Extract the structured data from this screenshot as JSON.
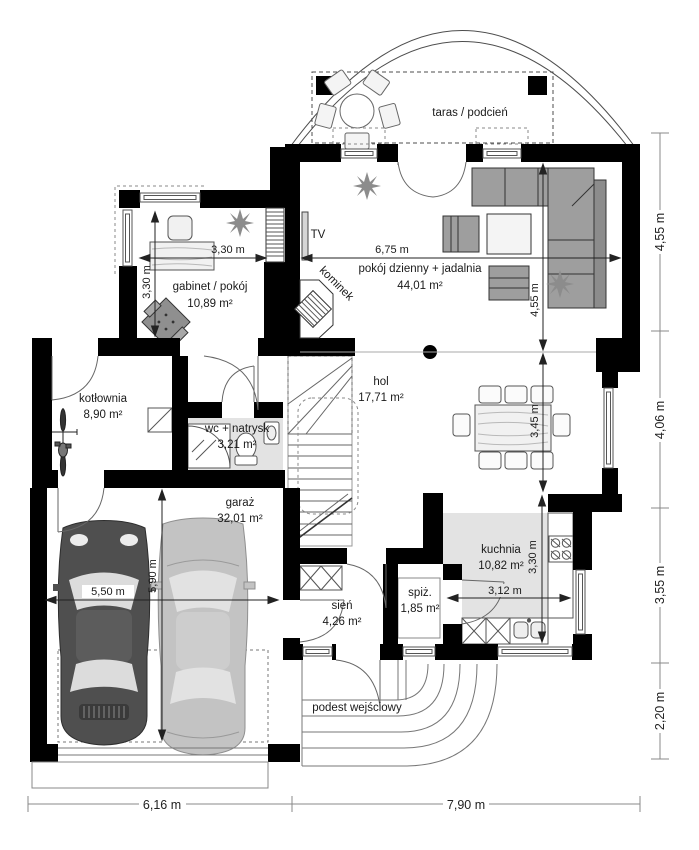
{
  "plan": {
    "type": "house ground floor plan"
  },
  "rooms": {
    "taras": {
      "label": "taras / podcień"
    },
    "living": {
      "label": "pokój dzienny + jadalnia",
      "area": "44,01 m²"
    },
    "gabinet": {
      "label": "gabinet / pokój",
      "area": "10,89 m²"
    },
    "kominek": {
      "label": "kominek"
    },
    "tv": {
      "label": "TV"
    },
    "kotlownia": {
      "label": "kotłownia",
      "area": "8,90 m²"
    },
    "wc": {
      "label": "wc + natrysk",
      "area": "3,21 m²"
    },
    "hol": {
      "label": "hol",
      "area": "17,71 m²"
    },
    "garaz": {
      "label": "garaż",
      "area": "32,01 m²"
    },
    "kuchnia": {
      "label": "kuchnia",
      "area": "10,82 m²"
    },
    "spiz": {
      "label": "spiż.",
      "area": "1,85 m²"
    },
    "sien": {
      "label": "sień",
      "area": "4,26 m²"
    },
    "podest": {
      "label": "podest wejściowy"
    }
  },
  "dims": {
    "gabinet_w": "3,30 m",
    "gabinet_h": "3,30 m",
    "living_w": "6,75 m",
    "living_h": "4,55 m",
    "hol_h": "3,45 m",
    "kuchnia_h": "3,30 m",
    "kuchnia_w": "3,12 m",
    "garaz_w": "5,50 m",
    "garaz_h": "5,90 m",
    "right": [
      "4,55 m",
      "4,06 m",
      "3,55 m",
      "2,20 m"
    ],
    "bottom": [
      "6,16 m",
      "7,90 m"
    ]
  },
  "colors": {
    "wall": "#000000",
    "line": "#4d4d4d",
    "floor_gray": "#e3e3e3",
    "furniture_gray": "#9e9e9e",
    "car_dark": "#4f4f4f",
    "car_light": "#c3c3c3",
    "text": "#1a1a1a"
  }
}
